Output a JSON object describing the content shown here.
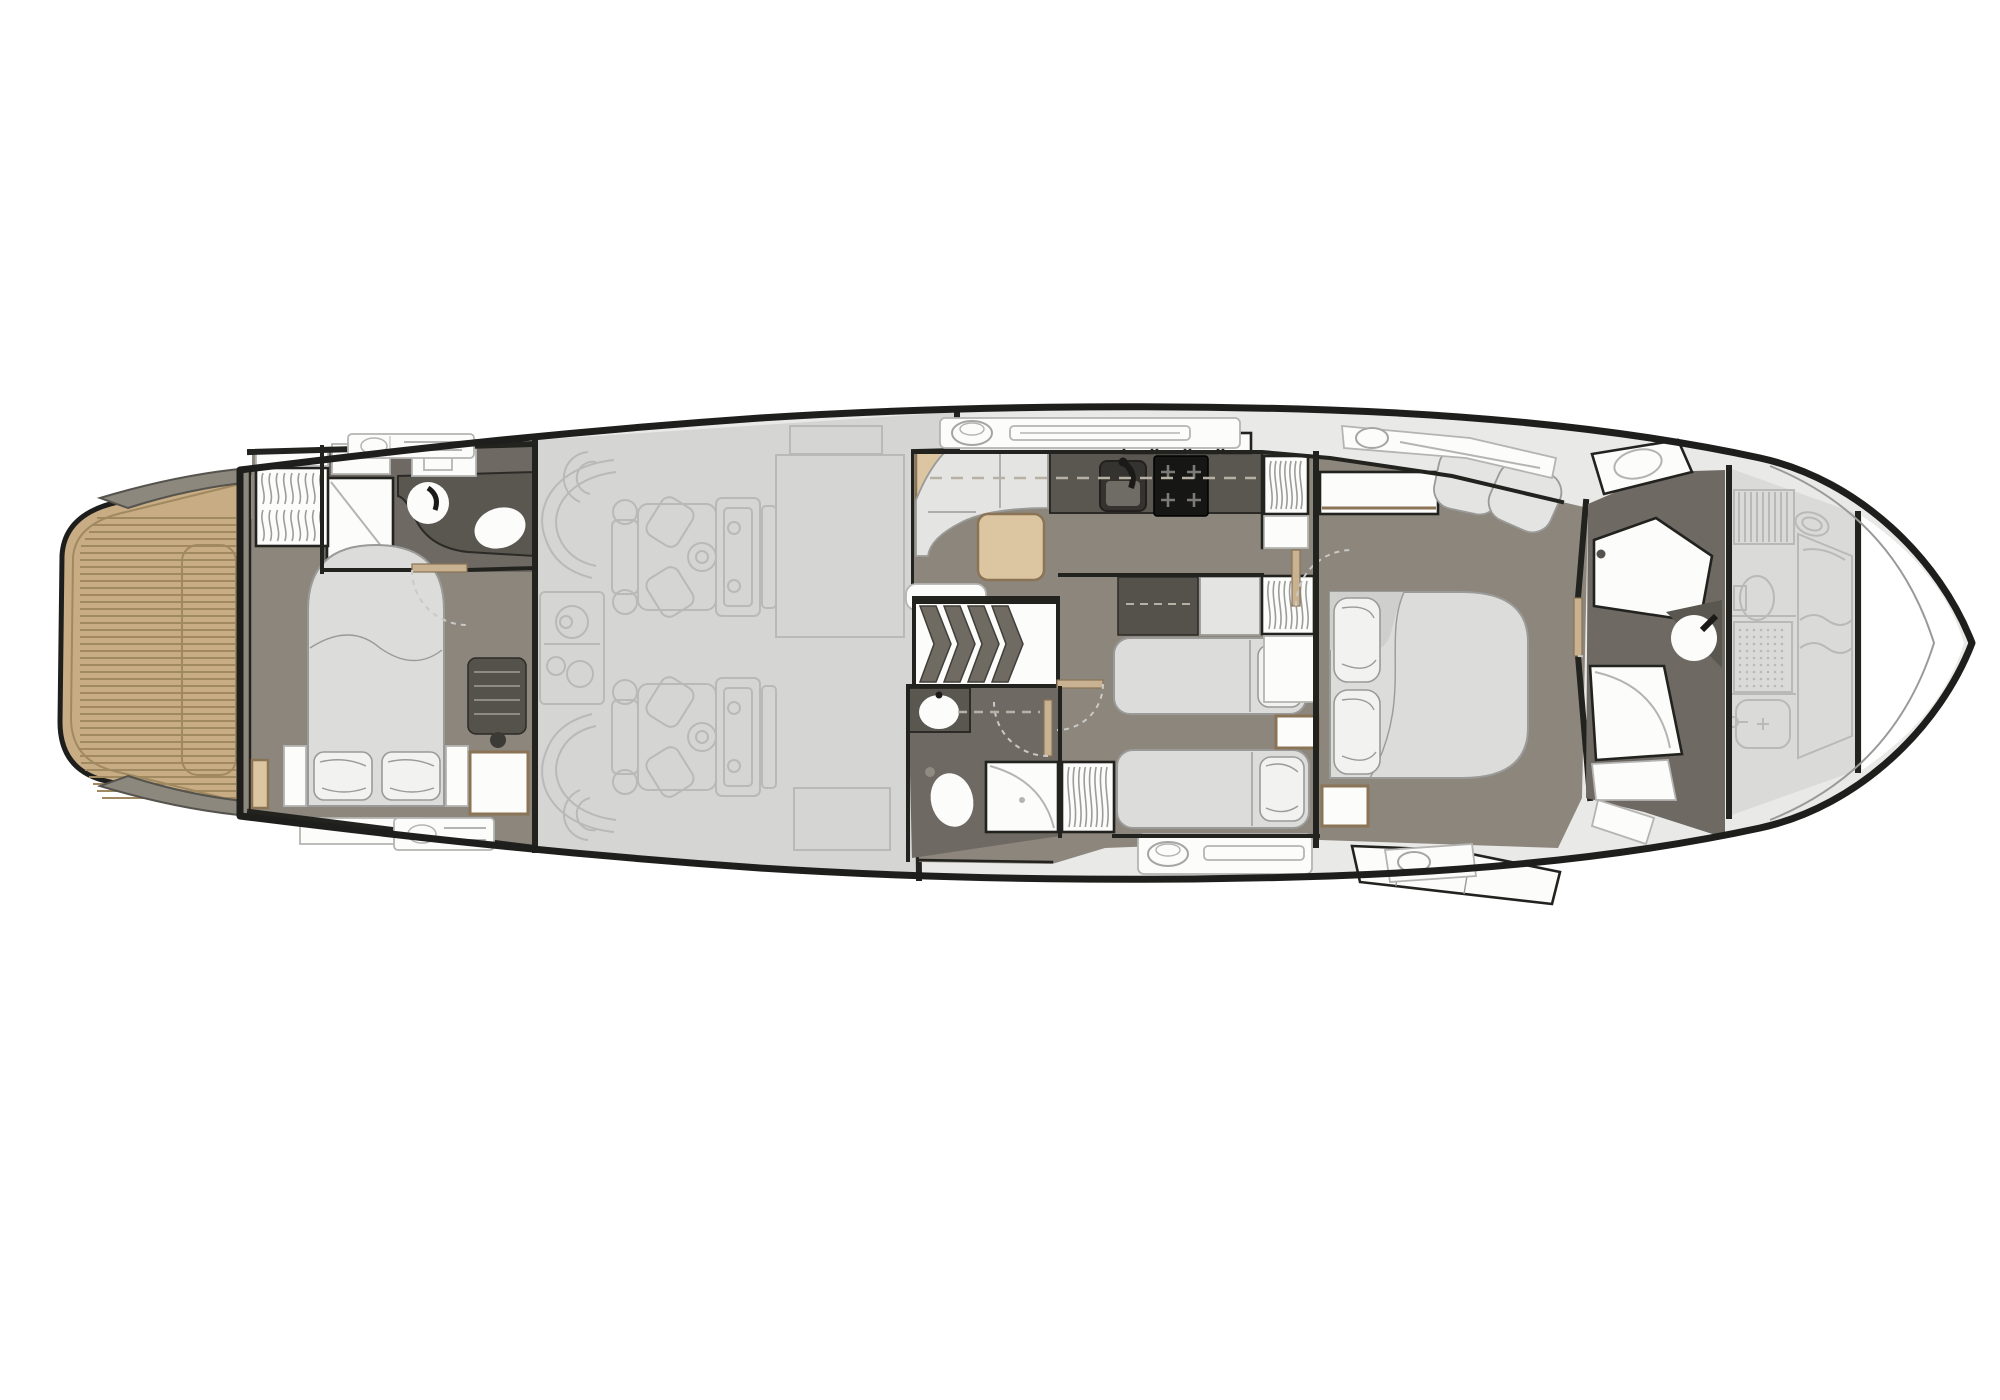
{
  "diagram": {
    "kind": "motor-yacht-lower-deck-floor-plan",
    "orientation": "bow-right",
    "rooms": [
      "swim-platform",
      "transom-cockpit-steps",
      "aft-cabin",
      "aft-bathroom",
      "engine-room",
      "dinette",
      "galley",
      "staircase",
      "corridor",
      "mid-bathroom",
      "twin-guest-cabin",
      "master-cabin",
      "forward-bathroom",
      "bow-crew-cabin",
      "bow-void"
    ],
    "fixtures": [
      "teak-decking",
      "deck-hatch",
      "hanging-locker",
      "shower",
      "wash-basin",
      "toilet",
      "bidet",
      "double-bed",
      "single-bed",
      "pillow",
      "nightstand",
      "sofa",
      "dinette-table",
      "galley-sink",
      "cooktop",
      "overhead-lockers",
      "stair-treads",
      "engine",
      "generator",
      "exhaust-duct",
      "fuel-tank",
      "fender",
      "boat-hook",
      "portlight",
      "vent-grille",
      "bench-seat",
      "drawer-unit",
      "door-leaf",
      "door-swing-arc",
      "centerline-dashes"
    ]
  },
  "palette": {
    "page_bg": "#ffffff",
    "hull_stroke": "#1e1e1c",
    "wall": "#22221f",
    "side_deck": "#e9e9e7",
    "stern_band": "#8d887e",
    "stern_edge": "#55534d",
    "teak": "#c8ac84",
    "teak_line": "#a08960",
    "engine_floor": "#d5d5d3",
    "faint_line": "#b9b9b7",
    "crew_fill": "#dadad8",
    "floor_dark": "#8c867c",
    "bath_floor": "#6e6963",
    "counter": "#5a5751",
    "counter_edge": "#2b2a27",
    "stove": "#161614",
    "burner": "#7c7a76",
    "furn_light": "#e4e4e2",
    "furn_edge": "#9a9a98",
    "bed_fill": "#dcdcda",
    "pillow": "#f2f2f0",
    "white": "#fcfcfb",
    "box_edge": "#b4b4b2",
    "wood": "#dcc5a1",
    "wood_edge": "#8a7455",
    "door": "#c8b292",
    "dark_unit": "#55524c",
    "slat": "#8f8b83",
    "dash": "#c9c9c7",
    "dash_cl": "#b7b1a5",
    "hanger": "#9c9c9a",
    "tread": "#6f6a62",
    "tread_edge": "#413e38",
    "landing": "#d2d2d0",
    "sink_dark": "#35332f",
    "sink_inner": "#6f6c66",
    "faucet": "#1b1a18"
  }
}
